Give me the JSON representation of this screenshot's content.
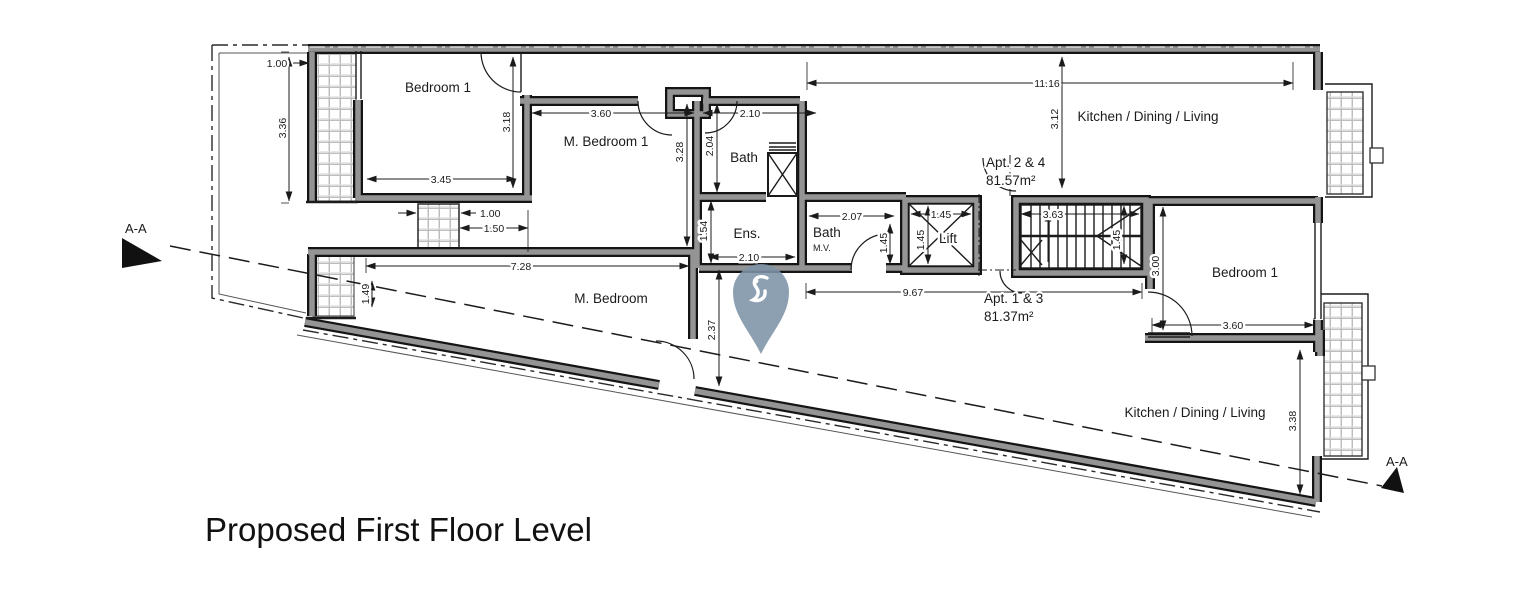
{
  "title": "Proposed First Floor Level",
  "section_markers": {
    "left": "A-A",
    "right": "A-A"
  },
  "apartments": {
    "apt24": {
      "name": "Apt. 2 & 4",
      "area": "81.57m²"
    },
    "apt13": {
      "name": "Apt. 1 & 3",
      "area": "81.37m²"
    }
  },
  "rooms": {
    "bedroom1_left": "Bedroom 1",
    "m_bedroom1": "M. Bedroom 1",
    "bath": "Bath",
    "ens": "Ens.",
    "kitchen_top": "Kitchen / Dining / Living",
    "bath_mv": "Bath",
    "bath_mv_note": "M.V.",
    "lift": "Lift",
    "m_bedroom": "M. Bedroom",
    "bedroom1_right": "Bedroom 1",
    "kitchen_bottom": "Kitchen / Dining / Living"
  },
  "dims": {
    "balc_l_w": "1.00",
    "balc_l_h": "3.36",
    "bed1_h": "3.18",
    "bed1_w": "3.45",
    "lw_w": "1.00",
    "lw_w2": "1.50",
    "mbr1_w": "3.60",
    "bath_w_top": "2.10",
    "bath_h": "2.04",
    "mbr1_h": "3.28",
    "ens_h": "1.54",
    "ens_w": "2.10",
    "kit_t_w": "11.16",
    "kit_t_h": "3.12",
    "bathmv_w": "2.07",
    "bathmv_d": "1.45",
    "lift_w": "1.45",
    "lift_h": "1.45",
    "stair_w": "3.63",
    "stair_h": "1.45",
    "hall_w": "9.67",
    "mbed_w": "7.28",
    "mbed_balc": "1.49",
    "mbed_d": "2.37",
    "bed1r_h": "3.00",
    "bed1r_w": "3.60",
    "kit_b_h": "3.38"
  },
  "watermark": {
    "color": "#7e93a7"
  },
  "colors": {
    "wall_core": "#949494",
    "wall_edge": "#141414",
    "hatch_line": "#bdbdbd"
  }
}
